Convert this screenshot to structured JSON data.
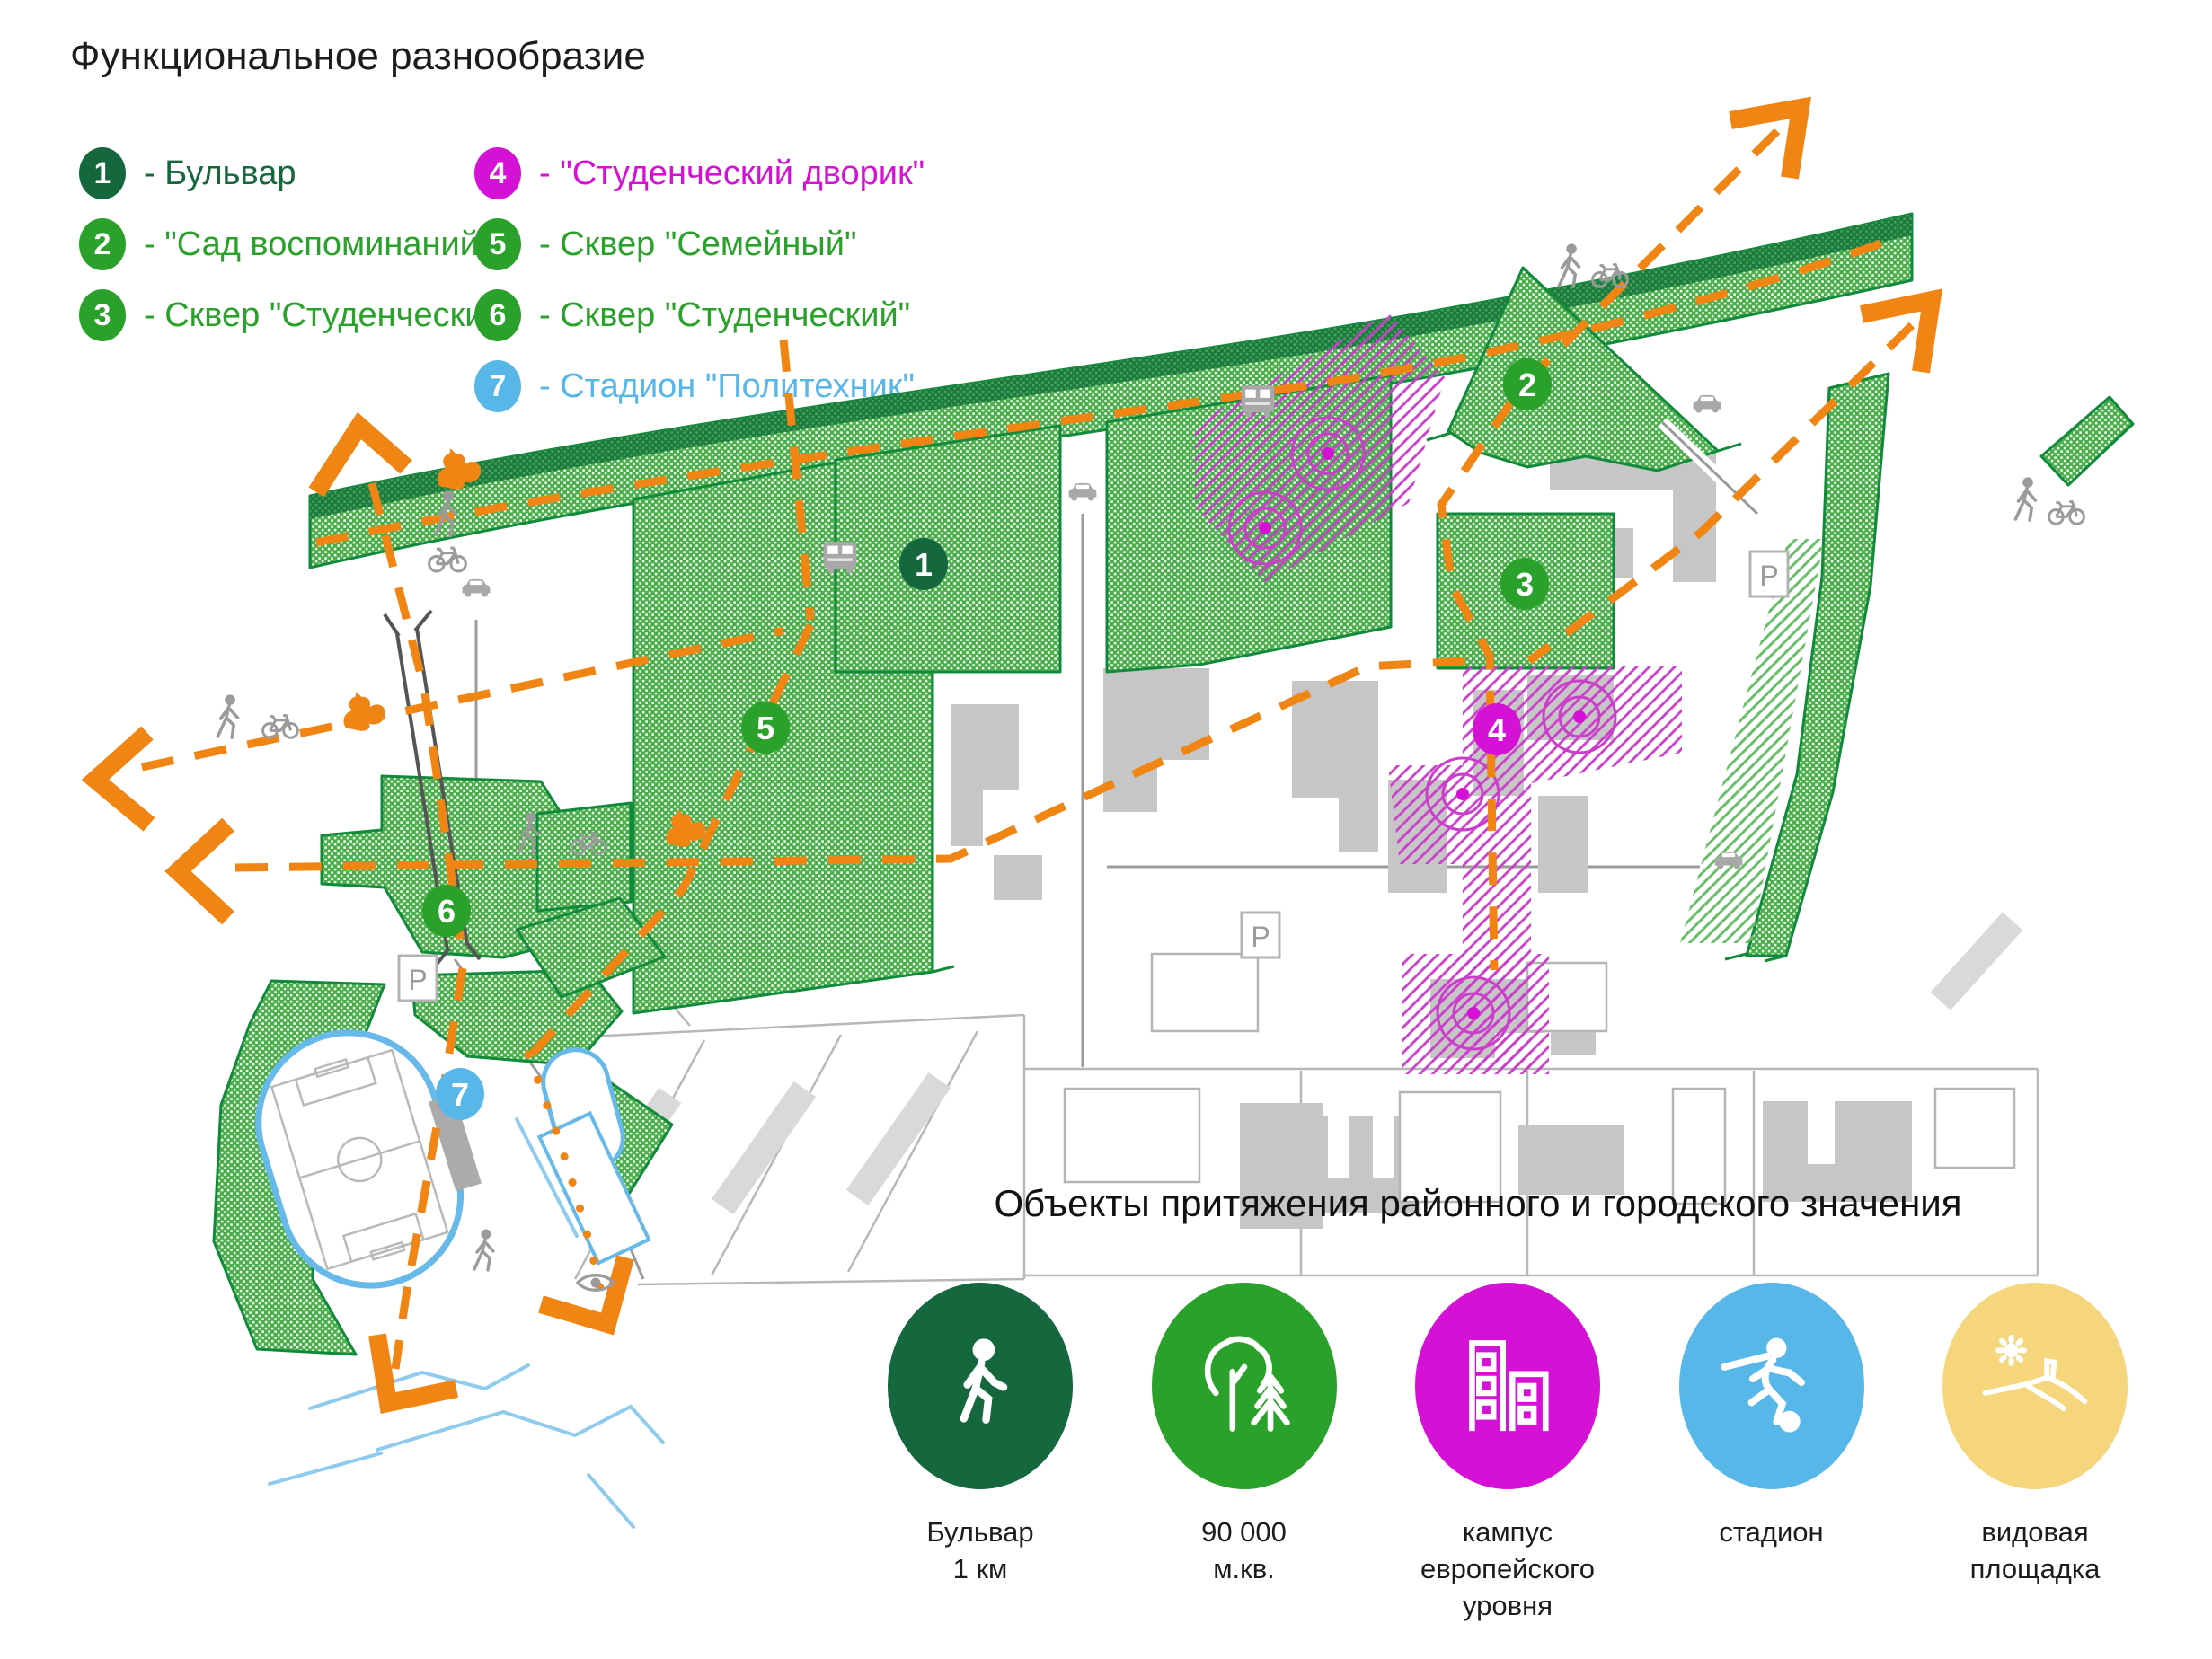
{
  "page_title": "Функциональное разнообразие",
  "legend": {
    "items": [
      {
        "num": "1",
        "label": "- Бульвар",
        "color": "#15673D"
      },
      {
        "num": "2",
        "label": "- \"Сад воспоминаний\"",
        "color": "#2AA12A"
      },
      {
        "num": "3",
        "label": "- Сквер \"Студенческий\"",
        "color": "#2AA12A"
      },
      {
        "num": "4",
        "label": "- \"Студенческий дворик\"",
        "color": "#D611D6"
      },
      {
        "num": "5",
        "label": "- Сквер \"Семейный\"",
        "color": "#2AA12A"
      },
      {
        "num": "6",
        "label": "- Сквер \"Студенческий\"",
        "color": "#2AA12A"
      },
      {
        "num": "7",
        "label": "- Стадион \"Политехник\"",
        "color": "#57B7E8"
      }
    ]
  },
  "map": {
    "parking_label": "P",
    "badges": [
      {
        "num": "1",
        "color": "#15673D"
      },
      {
        "num": "2",
        "color": "#2AA12A"
      },
      {
        "num": "3",
        "color": "#2AA12A"
      },
      {
        "num": "4",
        "color": "#D611D6"
      },
      {
        "num": "5",
        "color": "#2AA12A"
      },
      {
        "num": "6",
        "color": "#2AA12A"
      },
      {
        "num": "7",
        "color": "#57B7E8"
      }
    ],
    "colors": {
      "route_orange": "#F08514",
      "green_area": "#49AD49",
      "green_border": "#118A3C",
      "dark_green_band": "#1D7A3E",
      "magenta": "#D611D6",
      "stadium_blue": "#66B9E8",
      "building_gray": "#C6C6C6"
    }
  },
  "attractions": {
    "title": "Объекты притяжения районного и городского значения",
    "items": [
      {
        "icon": "walking-person-icon",
        "color": "#15673D",
        "lines": [
          "Бульвар",
          "1 км",
          ""
        ]
      },
      {
        "icon": "trees-icon",
        "color": "#2AA12A",
        "lines": [
          "90 000",
          "м.кв.",
          ""
        ]
      },
      {
        "icon": "campus-buildings-icon",
        "color": "#D611D6",
        "lines": [
          "кампус",
          "европейского",
          "уровня"
        ]
      },
      {
        "icon": "footballer-icon",
        "color": "#57B7E8",
        "lines": [
          "стадион",
          "",
          ""
        ]
      },
      {
        "icon": "viewpoint-icon",
        "color": "#F6D67D",
        "lines": [
          "видовая",
          "площадка",
          ""
        ]
      }
    ]
  }
}
